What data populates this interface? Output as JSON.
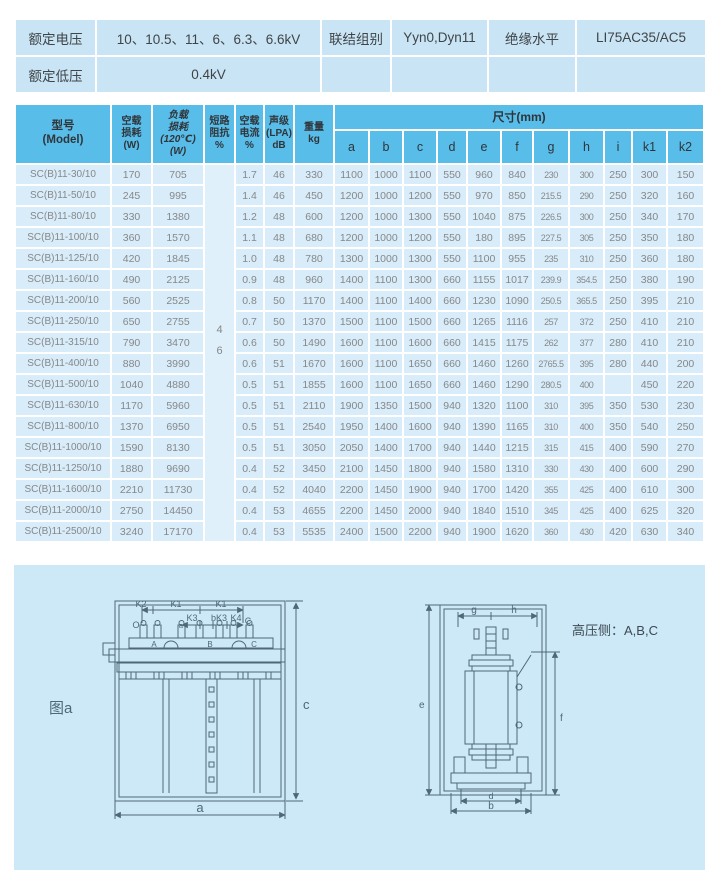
{
  "colors": {
    "header_bg": "#58bde9",
    "row_bg": "#d9ecf9",
    "impedance_bg": "#dff0fa",
    "spec_bar_bg": "#c9e5f5",
    "panel_bg": "#cde8f7",
    "drawing_line": "#4e6878",
    "header_text": "#30353a",
    "row_text": "#85888a"
  },
  "spec_bar": {
    "rated_voltage_label": "额定电压",
    "rated_voltage_value": "10、10.5、11、6、6.3、6.6kV",
    "connection_label": "联结组别",
    "connection_value": "Yyn0,Dyn11",
    "insulation_label": "绝缘水平",
    "insulation_value": "LI75AC35/AC5",
    "lv_label": "额定低压",
    "lv_value": "0.4kV"
  },
  "main_table": {
    "headers": {
      "model": "型号\n(Model)",
      "no_load_loss": "空载\n损耗\n(W)",
      "load_loss": "负载\n损耗\n(120℃)\n(W)",
      "impedance": "短路\n阻抗\n%",
      "no_load_current": "空载\n电流\n%",
      "sound_level": "声级\n(LPA)\ndB",
      "weight": "重量\nkg",
      "dims": "尺寸(mm)"
    },
    "dim_letters": [
      "a",
      "b",
      "c",
      "d",
      "e",
      "f",
      "g",
      "h",
      "i",
      "k1",
      "k2"
    ],
    "impedance_value": "4\n6",
    "rows": [
      [
        "SC(B)11-30/10",
        "170",
        "705",
        "1.7",
        "46",
        "330",
        "1100",
        "1000",
        "1100",
        "550",
        "960",
        "840",
        "230",
        "300",
        "250",
        "300",
        "150"
      ],
      [
        "SC(B)11-50/10",
        "245",
        "995",
        "1.4",
        "46",
        "450",
        "1200",
        "1000",
        "1200",
        "550",
        "970",
        "850",
        "215.5",
        "290",
        "250",
        "320",
        "160"
      ],
      [
        "SC(B)11-80/10",
        "330",
        "1380",
        "1.2",
        "48",
        "600",
        "1200",
        "1000",
        "1300",
        "550",
        "1040",
        "875",
        "226.5",
        "300",
        "250",
        "340",
        "170"
      ],
      [
        "SC(B)11-100/10",
        "360",
        "1570",
        "1.1",
        "48",
        "680",
        "1200",
        "1000",
        "1200",
        "550",
        "180",
        "895",
        "227.5",
        "305",
        "250",
        "350",
        "180"
      ],
      [
        "SC(B)11-125/10",
        "420",
        "1845",
        "1.0",
        "48",
        "780",
        "1300",
        "1000",
        "1300",
        "550",
        "1100",
        "955",
        "235",
        "310",
        "250",
        "360",
        "180"
      ],
      [
        "SC(B)11-160/10",
        "490",
        "2125",
        "0.9",
        "48",
        "960",
        "1400",
        "1100",
        "1300",
        "660",
        "1155",
        "1017",
        "239.9",
        "354.5",
        "250",
        "380",
        "190"
      ],
      [
        "SC(B)11-200/10",
        "560",
        "2525",
        "0.8",
        "50",
        "1170",
        "1400",
        "1100",
        "1400",
        "660",
        "1230",
        "1090",
        "250.5",
        "365.5",
        "250",
        "395",
        "210"
      ],
      [
        "SC(B)11-250/10",
        "650",
        "2755",
        "0.7",
        "50",
        "1370",
        "1500",
        "1100",
        "1500",
        "660",
        "1265",
        "1116",
        "257",
        "372",
        "250",
        "410",
        "210"
      ],
      [
        "SC(B)11-315/10",
        "790",
        "3470",
        "0.6",
        "50",
        "1490",
        "1600",
        "1100",
        "1600",
        "660",
        "1415",
        "1175",
        "262",
        "377",
        "280",
        "410",
        "210"
      ],
      [
        "SC(B)11-400/10",
        "880",
        "3990",
        "0.6",
        "51",
        "1670",
        "1600",
        "1100",
        "1650",
        "660",
        "1460",
        "1260",
        "2765.5",
        "395",
        "280",
        "440",
        "200"
      ],
      [
        "SC(B)11-500/10",
        "1040",
        "4880",
        "0.5",
        "51",
        "1855",
        "1600",
        "1100",
        "1650",
        "660",
        "1460",
        "1290",
        "280.5",
        "400",
        "",
        "450",
        "220"
      ],
      [
        "SC(B)11-630/10",
        "1170",
        "5960",
        "0.5",
        "51",
        "2110",
        "1900",
        "1350",
        "1500",
        "940",
        "1320",
        "1100",
        "310",
        "395",
        "350",
        "530",
        "230"
      ],
      [
        "SC(B)11-800/10",
        "1370",
        "6950",
        "0.5",
        "51",
        "2540",
        "1950",
        "1400",
        "1600",
        "940",
        "1390",
        "1165",
        "310",
        "400",
        "350",
        "540",
        "250"
      ],
      [
        "SC(B)11-1000/10",
        "1590",
        "8130",
        "0.5",
        "51",
        "3050",
        "2050",
        "1400",
        "1700",
        "940",
        "1440",
        "1215",
        "315",
        "415",
        "400",
        "590",
        "270"
      ],
      [
        "SC(B)11-1250/10",
        "1880",
        "9690",
        "0.4",
        "52",
        "3450",
        "2100",
        "1450",
        "1800",
        "940",
        "1580",
        "1310",
        "330",
        "430",
        "400",
        "600",
        "290"
      ],
      [
        "SC(B)11-1600/10",
        "2210",
        "11730",
        "0.4",
        "52",
        "4040",
        "2200",
        "1450",
        "1900",
        "940",
        "1700",
        "1420",
        "355",
        "425",
        "400",
        "610",
        "300"
      ],
      [
        "SC(B)11-2000/10",
        "2750",
        "14450",
        "0.4",
        "53",
        "4655",
        "2200",
        "1450",
        "2000",
        "940",
        "1840",
        "1510",
        "345",
        "425",
        "400",
        "625",
        "320"
      ],
      [
        "SC(B)11-2500/10",
        "3240",
        "17170",
        "0.4",
        "53",
        "5535",
        "2400",
        "1500",
        "2200",
        "940",
        "1900",
        "1620",
        "360",
        "430",
        "420",
        "630",
        "340"
      ]
    ]
  },
  "diagram": {
    "caption": "图a",
    "hv_note": "高压侧：A,B,C",
    "front": {
      "k2": "K2",
      "k1a": "K1",
      "k1b": "K1",
      "o": "O",
      "small_a": "a",
      "k3": "K3",
      "bk3": "bK3",
      "k4": "K4",
      "corner_c": "C",
      "term_a": "A",
      "term_b": "B",
      "term_c": "C",
      "dim_c": "c",
      "dim_a": "a"
    },
    "side": {
      "g": "g",
      "h": "h",
      "e": "e",
      "f": "f",
      "d": "d",
      "b": "b"
    }
  }
}
